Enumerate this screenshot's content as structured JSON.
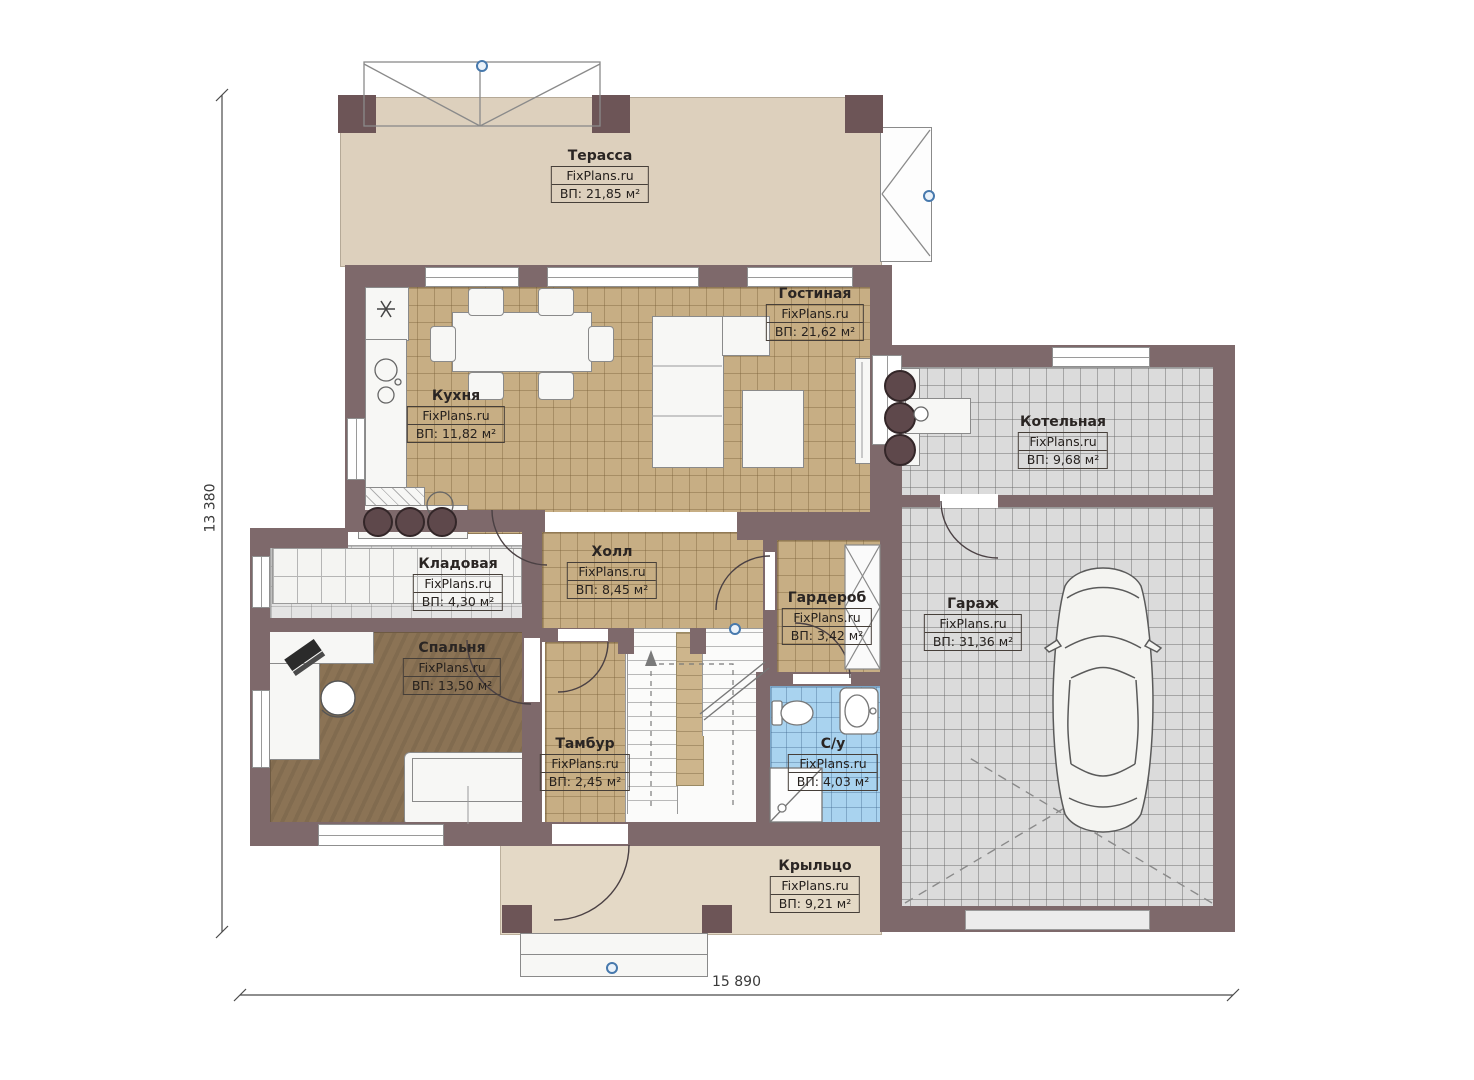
{
  "brand": "FixPlans.ru",
  "rooms": [
    {
      "name": "Терасса",
      "brand": "FixPlans.ru",
      "area": "ВП: 21,85 м²"
    },
    {
      "name": "Гостиная",
      "brand": "FixPlans.ru",
      "area": "ВП: 21,62 м²"
    },
    {
      "name": "Кухня",
      "brand": "FixPlans.ru",
      "area": "ВП: 11,82 м²"
    },
    {
      "name": "Котельная",
      "brand": "FixPlans.ru",
      "area": "ВП: 9,68 м²"
    },
    {
      "name": "Гараж",
      "brand": "FixPlans.ru",
      "area": "ВП: 31,36 м²"
    },
    {
      "name": "Кладовая",
      "brand": "FixPlans.ru",
      "area": "ВП: 4,30 м²"
    },
    {
      "name": "Холл",
      "brand": "FixPlans.ru",
      "area": "ВП: 8,45 м²"
    },
    {
      "name": "Гардероб",
      "brand": "FixPlans.ru",
      "area": "ВП: 3,42 м²"
    },
    {
      "name": "Спальня",
      "brand": "FixPlans.ru",
      "area": "ВП: 13,50 м²"
    },
    {
      "name": "Тамбур",
      "brand": "FixPlans.ru",
      "area": "ВП: 2,45 м²"
    },
    {
      "name": "С/у",
      "brand": "FixPlans.ru",
      "area": "ВП: 4,03 м²"
    },
    {
      "name": "Крыльцо",
      "brand": "FixPlans.ru",
      "area": "ВП: 9,21 м²"
    }
  ],
  "dims": {
    "height_label": "13 380",
    "width_label": "15 890"
  },
  "colors": {
    "wall": "#7e696b",
    "pillar": "#6d5557",
    "tile_tan": "#c7ae84",
    "tile_grey": "#dbdbdb",
    "tile_blue": "#a9d3ef",
    "bedroom_floor": "#8b7355",
    "terrace": "#ddd0bd",
    "porch": "#e4d9c6",
    "marker_blue": "#4779ad"
  }
}
